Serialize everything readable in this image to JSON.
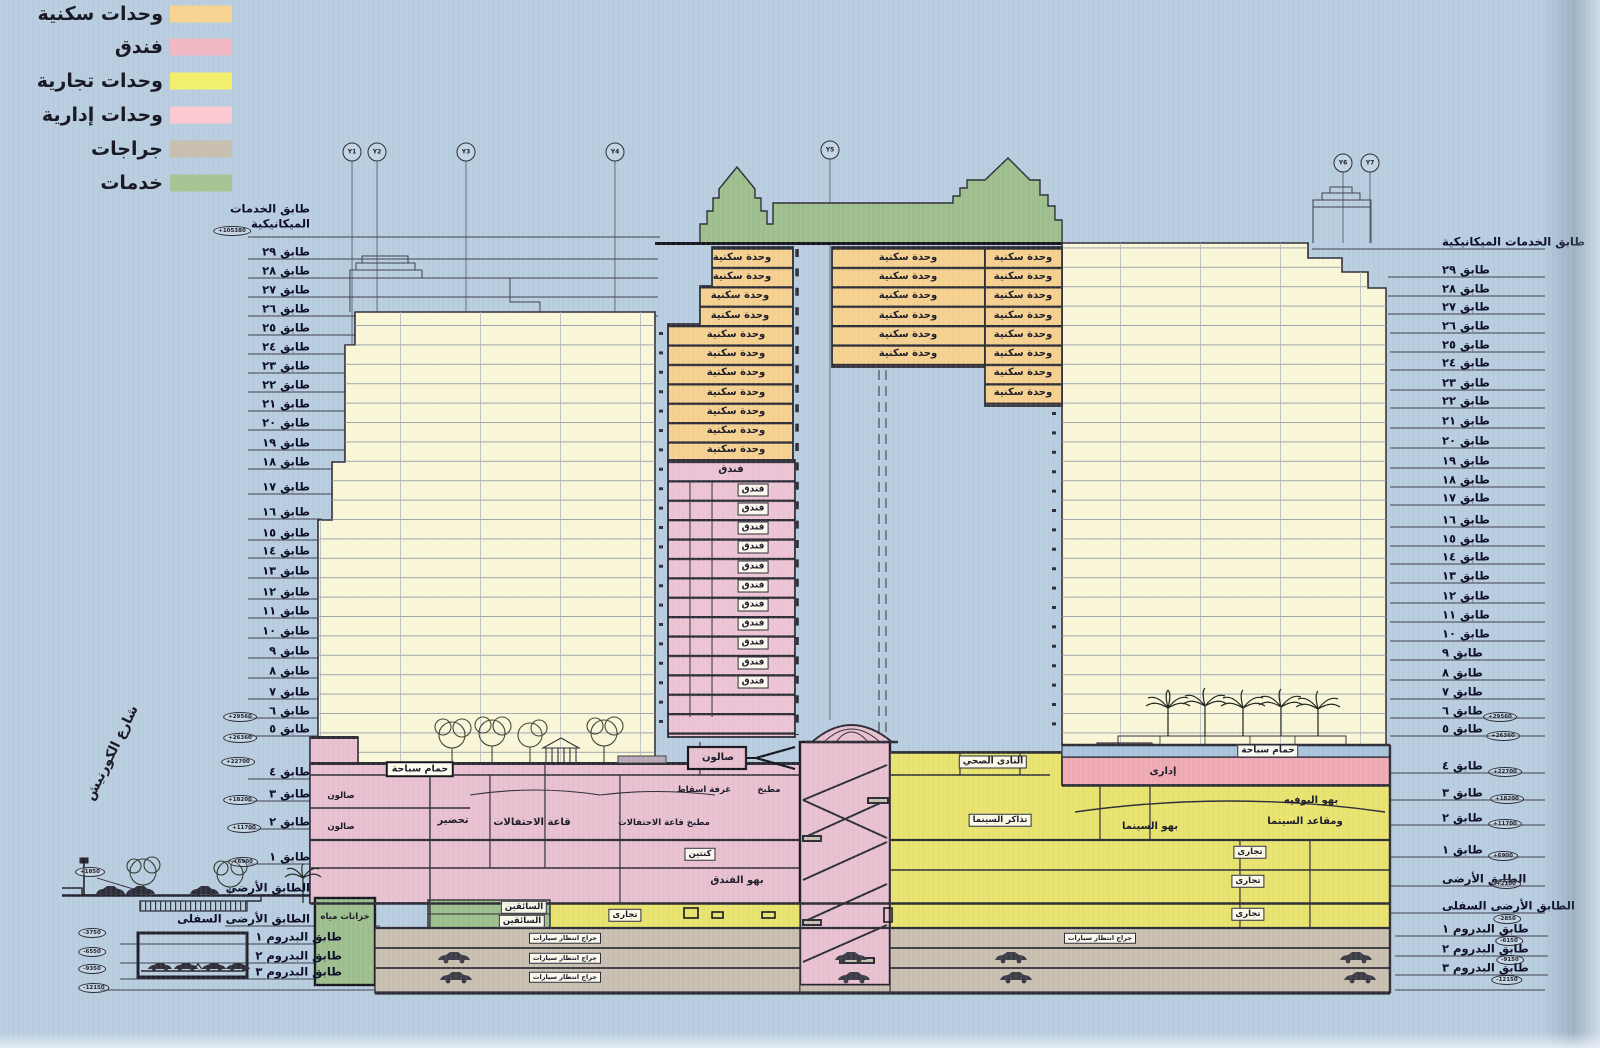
{
  "legend": {
    "items": [
      {
        "label": "وحدات سكنية",
        "color": "#f7d492"
      },
      {
        "label": "فندق",
        "color": "#f2b9c4"
      },
      {
        "label": "وحدات تجارية",
        "color": "#f3ef6e"
      },
      {
        "label": "وحدات إدارية",
        "color": "#fbcad0"
      },
      {
        "label": "جراجات",
        "color": "#c9bfae"
      },
      {
        "label": "خدمات",
        "color": "#a5c694"
      }
    ]
  },
  "street_label": "شارع الكورنيش",
  "grid_markers": [
    "Y1",
    "Y2",
    "Y3",
    "Y4",
    "Y5",
    "Y6",
    "Y7"
  ],
  "floors": {
    "mech_line1": "طابق الخدمات",
    "mech_line2": "الميكانيكية",
    "mech_right": "طابق الخدمات الميكانيكية",
    "names": [
      "طابق ٢٩",
      "طابق ٢٨",
      "طابق ٢٧",
      "طابق ٢٦",
      "طابق ٢٥",
      "طابق ٢٤",
      "طابق ٢٣",
      "طابق ٢٢",
      "طابق ٢١",
      "طابق ٢٠",
      "طابق ١٩",
      "طابق ١٨",
      "طابق ١٧",
      "طابق ١٦",
      "طابق ١٥",
      "طابق ١٤",
      "طابق ١٣",
      "طابق ١٢",
      "طابق ١١",
      "طابق ١٠",
      "طابق ٩",
      "طابق ٨",
      "طابق ٧",
      "طابق ٦",
      "طابق ٥",
      "طابق ٤",
      "طابق ٣",
      "طابق ٢",
      "طابق ١"
    ],
    "ground": "الطابق الأرضى",
    "lower_ground": "الطابق الأرضى السفلى",
    "basements": [
      "طابق البدروم ١",
      "طابق البدروم ٢",
      "طابق البدروم ٣"
    ]
  },
  "elevations": {
    "mech": "+105380",
    "f6": "+29560",
    "f5": "+26360",
    "f4": "+22700",
    "f3": "+18200",
    "f2": "+11700",
    "f1": "+6900",
    "ground_left": "+1850",
    "ground_right": "+2100",
    "lower_ground": "-2850",
    "b1_left": "-3750",
    "b2_left": "-6550",
    "b3_left": "-9350",
    "b1_right": "-6150",
    "b2_right": "-9150",
    "b3_right": "-12150",
    "bottom_left": "-12150"
  },
  "rooms": {
    "residential_unit": "وحدة سكنية",
    "hotel": "فندق",
    "salon": "صالون",
    "pool": "حمام سباحة",
    "prep": "تحضير",
    "ballroom": "قاعة الاحتفالات",
    "ballroom_kitchen": "مطبخ قاعة الاحتفالات",
    "kitchen": "مطبخ",
    "projection_room": "غرفة اسقاط",
    "canteen": "كنتين",
    "hotel_lobby": "بهو الفندق",
    "health_club": "النادى الصحي",
    "admin": "إدارى",
    "cinema_tickets": "تذاكر السينما",
    "cinema_lobby": "بهو السينما",
    "buffet_lobby": "بهو البوفيه",
    "cinema_seats": "ومقاعد السينما",
    "commercial": "تجارى",
    "drivers": "السائقين",
    "water_tanks": "خزانات مياه",
    "parking_garage": "جراج انتظار سيارات"
  }
}
